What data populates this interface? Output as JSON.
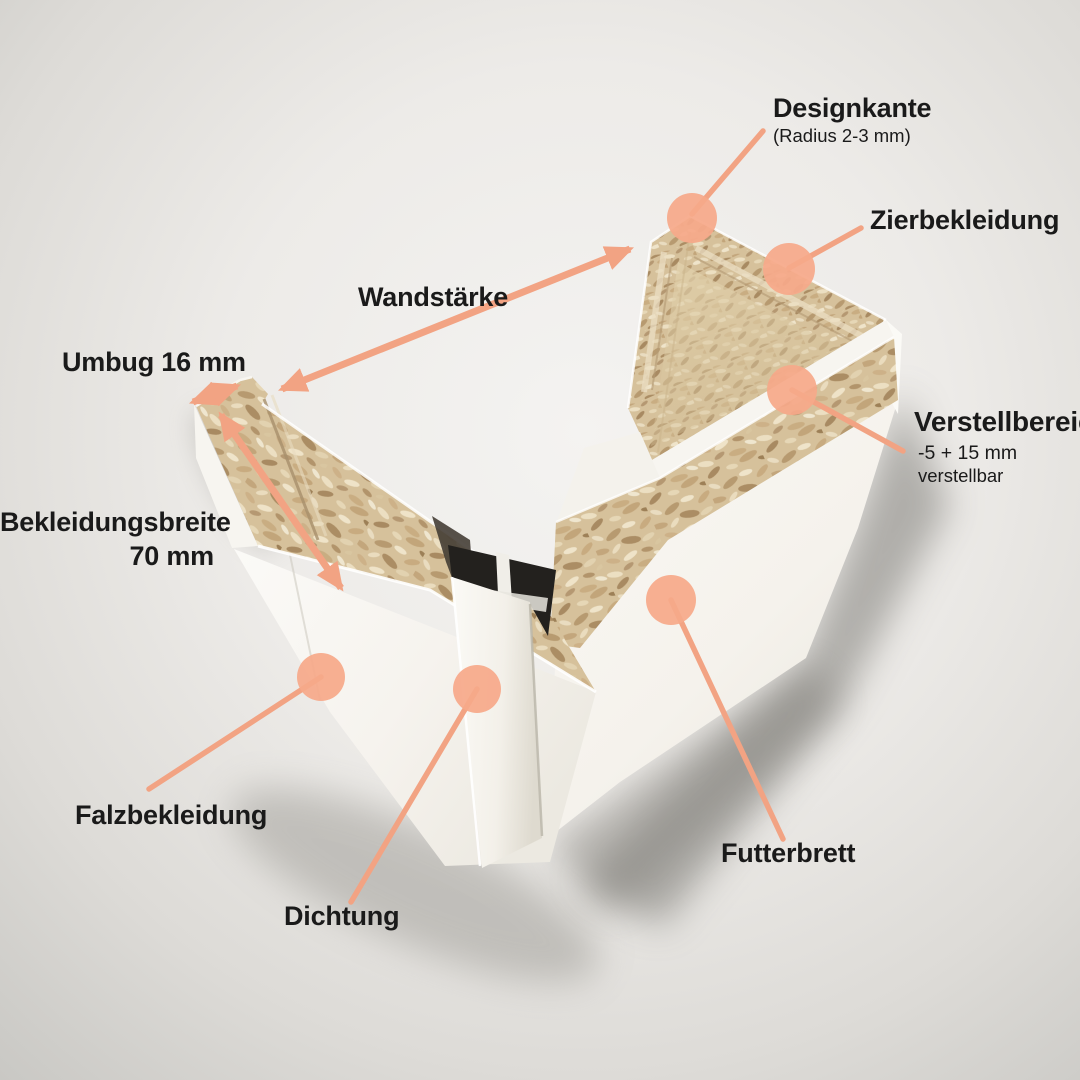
{
  "colors": {
    "accent_line": "#F2A383",
    "accent_dot": "#F6A98A",
    "label_text": "#1a1a1a",
    "bg_center": "#f4f3f1",
    "bg_edge": "#c9c8c4"
  },
  "callouts": {
    "designkante": {
      "label": "Designkante",
      "note": "(Radius 2-3 mm)"
    },
    "zierbekleidung": {
      "label": "Zierbekleidung"
    },
    "wandstaerke": {
      "label": "Wandstärke"
    },
    "umbug": {
      "label": "Umbug 16 mm"
    },
    "bekleidungsbreite": {
      "label": "Bekleidungsbreite",
      "value": "70 mm"
    },
    "verstellbereich": {
      "label": "Verstellbereich",
      "note1": "-5 + 15 mm",
      "note2": "verstellbar"
    },
    "falzbekleidung": {
      "label": "Falzbekleidung"
    },
    "dichtung": {
      "label": "Dichtung"
    },
    "futterbrett": {
      "label": "Futterbrett"
    }
  }
}
